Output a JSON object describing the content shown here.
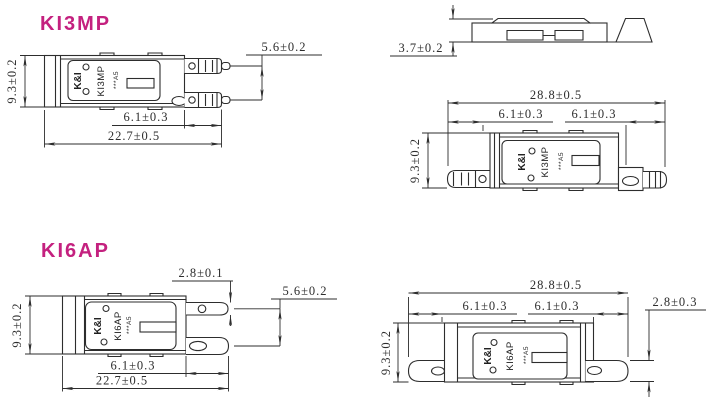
{
  "colors": {
    "accent": "#c4217f",
    "line": "#2d2d2d",
    "background": "#ffffff"
  },
  "ki3mp_single": {
    "title": "KI3MP",
    "label": {
      "brand": "K&I",
      "model": "KI3MP",
      "code": "***A5"
    },
    "dims": {
      "height": "9.3±0.2",
      "pitch": "5.6±0.2",
      "terminal": "6.1±0.3",
      "total": "22.7±0.5"
    }
  },
  "ki3mp_profile": {
    "dims": {
      "thickness": "3.7±0.2"
    }
  },
  "ki3mp_double": {
    "label": {
      "brand": "K&I",
      "model": "KI3MP",
      "code": "***A5"
    },
    "dims": {
      "total": "28.8±0.5",
      "terminal_left": "6.1±0.3",
      "terminal_right": "6.1±0.3",
      "height": "9.3±0.2"
    }
  },
  "ki6ap_single": {
    "title": "KI6AP",
    "label": {
      "brand": "K&I",
      "model": "KI6AP",
      "code": "***A5"
    },
    "dims": {
      "blade_width": "2.8±0.1",
      "pitch": "5.6±0.2",
      "height": "9.3±0.2",
      "terminal": "6.1±0.3",
      "total": "22.7±0.5"
    }
  },
  "ki6ap_double": {
    "label": {
      "brand": "K&I",
      "model": "KI6AP",
      "code": "***A5"
    },
    "dims": {
      "total": "28.8±0.5",
      "terminal_left": "6.1±0.3",
      "terminal_right": "6.1±0.3",
      "height": "9.3±0.2",
      "blade_thickness": "2.8±0.3"
    }
  }
}
